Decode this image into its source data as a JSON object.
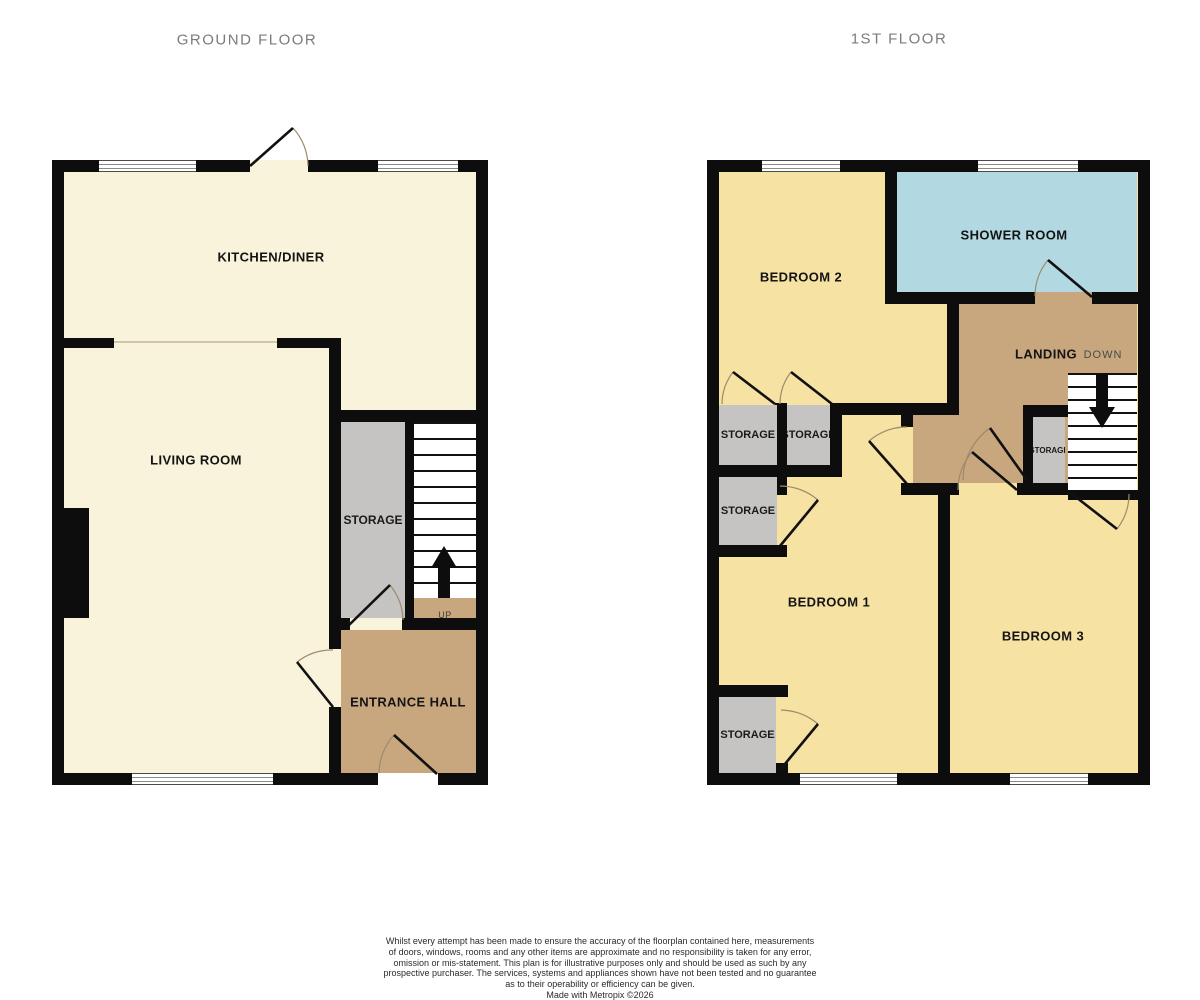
{
  "titles": {
    "ground_floor": "GROUND FLOOR",
    "first_floor": "1ST FLOOR"
  },
  "ground_floor": {
    "rooms": {
      "kitchen_diner": "KITCHEN/DINER",
      "living_room": "LIVING ROOM",
      "storage": "STORAGE",
      "entrance_hall": "ENTRANCE HALL"
    },
    "stairs_label": "UP"
  },
  "first_floor": {
    "rooms": {
      "bedroom_2": "BEDROOM 2",
      "shower_room": "SHOWER ROOM",
      "landing": "LANDING",
      "bedroom_1": "BEDROOM 1",
      "bedroom_3": "BEDROOM 3",
      "storage_top_left": "STORAGE",
      "storage_top_mid": "STORAGE",
      "storage_mid_left": "STORAGE",
      "storage_bottom_left": "STORAGE",
      "storage_landing": "STORAGE"
    },
    "stairs_label": "DOWN"
  },
  "colors": {
    "wall": "#0d0d0d",
    "ground_floor_room": "#f8f3da",
    "bedroom_yellow": "#f6e3a4",
    "hall_landing_tan": "#c8a77e",
    "shower_blue": "#b2d9e1",
    "storage_gray": "#c5c4c3",
    "title_gray": "#7b7b7b"
  },
  "footer": {
    "lines": [
      "Whilst every attempt has been made to ensure the accuracy of the floorplan contained here, measurements",
      "of doors, windows, rooms and any other items are approximate and no responsibility is taken for any error,",
      "omission or mis-statement. This plan is for illustrative purposes only and should be used as such by any",
      "prospective purchaser. The services, systems and appliances shown have not been tested and no guarantee",
      "as to their operability or efficiency can be given.",
      "Made with Metropix ©2026"
    ]
  }
}
